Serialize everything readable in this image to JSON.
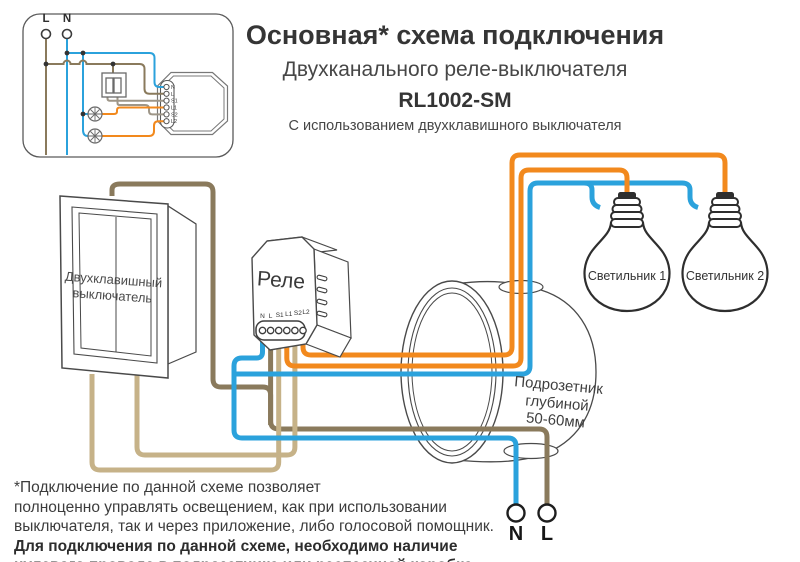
{
  "title": {
    "heading": "Основная* схема подключения",
    "subheading": "Двухканального реле-выключателя",
    "model": "RL1002-SM",
    "note": "С использованием двухклавишного выключателя"
  },
  "inset": {
    "l_label": "L",
    "n_label": "N"
  },
  "relay": {
    "label": "Реле",
    "terminals": [
      "N",
      "L",
      "S1",
      "L1",
      "S2",
      "L2"
    ]
  },
  "wall_switch": {
    "line1": "Двухклавишный",
    "line2": "выключатель"
  },
  "junction_box": {
    "line1": "Подрозетник",
    "line2": "глубиной",
    "line3": "50-60мм"
  },
  "lamps": {
    "lamp1": "Светильник 1",
    "lamp2": "Светильник 2"
  },
  "supply": {
    "n_label": "N",
    "l_label": "L"
  },
  "footnote": {
    "line1": "*Подключение по данной схеме позволяет",
    "line2": "полноценно управлять освещением, как при использовании",
    "line3": "выключателя, так и через приложение, либо голосовой помощник.",
    "line4": "Для подключения по данной схеме, необходимо наличие",
    "line5": "нулевого провода в подрозетнике или распаечной коробке."
  },
  "colors": {
    "wire_blue": "#2ba2dc",
    "wire_orange": "#f2891d",
    "wire_brown": "#8a7a5c",
    "wire_tan": "#c6b288",
    "wire_gray_tan": "#9e9688",
    "outline": "#4a4a4a"
  }
}
